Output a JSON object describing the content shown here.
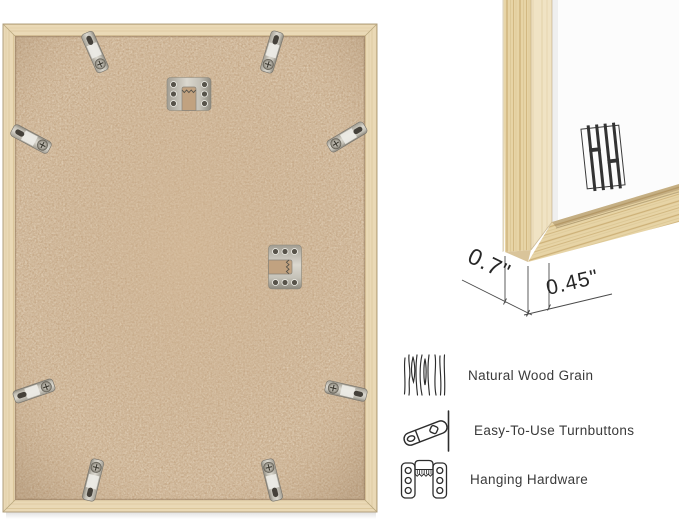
{
  "canvas": {
    "width": 679,
    "height": 523,
    "background": "#ffffff"
  },
  "back_view": {
    "turnbutton_count": 8,
    "hanger_count": 2
  },
  "corner_view": {
    "brand_mark": "HH"
  },
  "dimensions": {
    "frame_depth": "0.7\"",
    "frame_face_width": "0.45\""
  },
  "features": [
    {
      "icon": "wood-grain-icon",
      "label": "Natural Wood Grain"
    },
    {
      "icon": "turnbutton-icon",
      "label": "Easy-To-Use Turnbuttons"
    },
    {
      "icon": "hanging-hardware-icon",
      "label": "Hanging Hardware"
    }
  ],
  "colors": {
    "wood_light": "#ead9b6",
    "wood_grain": "#d2bb8e",
    "oak_face": "#e7d4a6",
    "backing_tan": "#c7aa89",
    "metal_silver": "#d6d3ca",
    "mat_white": "#fcfcfc",
    "text": "#3a3a3a",
    "dimension_text": "#272727",
    "line": "#4a4a4a"
  }
}
